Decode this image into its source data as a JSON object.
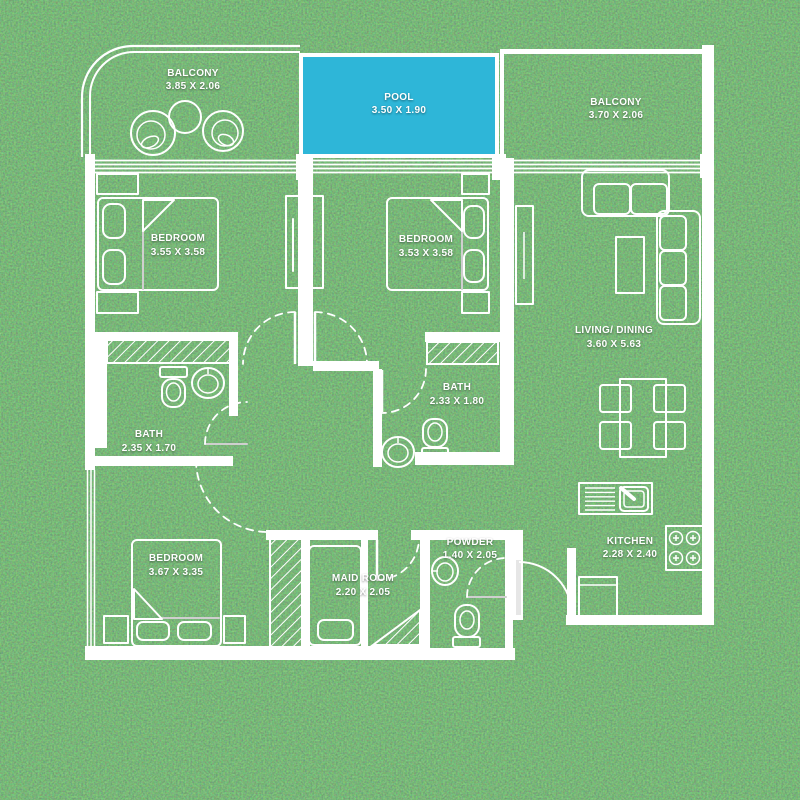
{
  "colors": {
    "pool_fill": "#2eb6d8",
    "wall": "#ffffff",
    "grass_mid": "#2e7434",
    "label_text": "#ffffff"
  },
  "rooms": {
    "balcony_left": {
      "name": "BALCONY",
      "dims": "3.85 X 2.06"
    },
    "pool": {
      "name": "POOL",
      "dims": "3.50 X 1.90"
    },
    "balcony_right": {
      "name": "BALCONY",
      "dims": "3.70 X 2.06"
    },
    "bedroom_1": {
      "name": "BEDROOM",
      "dims": "3.55 X 3.58"
    },
    "bedroom_2": {
      "name": "BEDROOM",
      "dims": "3.53 X 3.58"
    },
    "living_dining": {
      "name": "LIVING/ DINING",
      "dims": "3.60 X 5.63"
    },
    "bath_1": {
      "name": "BATH",
      "dims": "2.35 X 1.70"
    },
    "bath_2": {
      "name": "BATH",
      "dims": "2.33 X 1.80"
    },
    "bedroom_3": {
      "name": "BEDROOM",
      "dims": "3.67 X 3.35"
    },
    "maid_room": {
      "name": "MAID ROOM",
      "dims": "2.20 X 2.05"
    },
    "powder": {
      "name": "POWDER",
      "dims": "1.40 X 2.05"
    },
    "kitchen": {
      "name": "KITCHEN",
      "dims": "2.28 X 2.40"
    }
  },
  "icons": [
    "bed-icon",
    "pillow-icon",
    "nightstand-icon",
    "wardrobe-icon",
    "sofa-icon",
    "coffee-table-icon",
    "dining-table-icon",
    "dining-chair-icon",
    "toilet-icon",
    "sink-icon",
    "shower-hatch-icon",
    "kitchen-sink-icon",
    "stove-icon",
    "cabinet-icon",
    "door-swing-icon",
    "balcony-chair-icon",
    "balcony-table-icon",
    "window-icon",
    "sliding-door-icon"
  ]
}
